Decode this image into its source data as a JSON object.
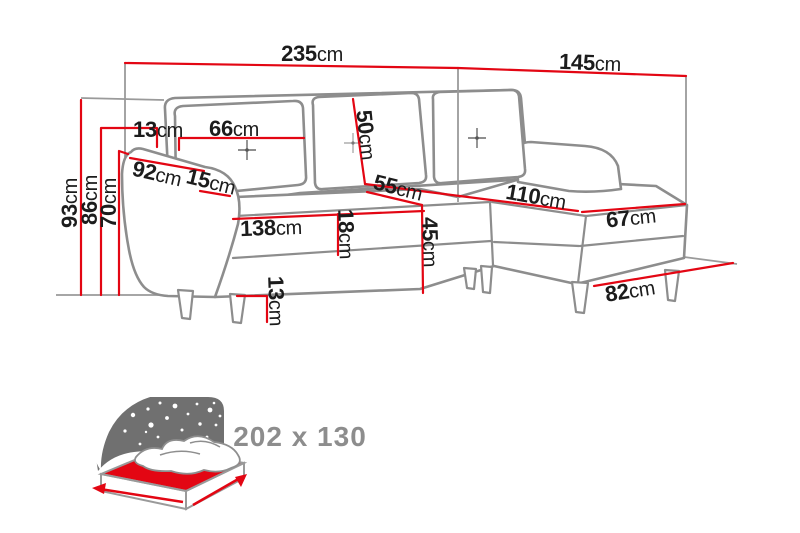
{
  "diagram_type": "corner-sofa-dimension-diagram",
  "unit": "cm",
  "dims": {
    "w235": {
      "num": "235",
      "unit": "cm"
    },
    "w145": {
      "num": "145",
      "unit": "cm"
    },
    "h93": {
      "num": "93",
      "unit": "cm"
    },
    "h86": {
      "num": "86",
      "unit": "cm"
    },
    "h70": {
      "num": "70",
      "unit": "cm"
    },
    "t13": {
      "num": "13",
      "unit": "cm"
    },
    "c66": {
      "num": "66",
      "unit": "cm"
    },
    "b50": {
      "num": "50",
      "unit": "cm"
    },
    "a92": {
      "num": "92",
      "unit": "cm"
    },
    "a15": {
      "num": "15",
      "unit": "cm"
    },
    "s55": {
      "num": "55",
      "unit": "cm"
    },
    "ch110": {
      "num": "110",
      "unit": "cm"
    },
    "s138": {
      "num": "138",
      "unit": "cm"
    },
    "s18": {
      "num": "18",
      "unit": "cm"
    },
    "s45": {
      "num": "45",
      "unit": "cm"
    },
    "ch67": {
      "num": "67",
      "unit": "cm"
    },
    "leg13": {
      "num": "13",
      "unit": "cm"
    },
    "ch82": {
      "num": "82",
      "unit": "cm"
    }
  },
  "bed": {
    "icon": "sofa-bed-icon",
    "size": "202 x 130"
  },
  "colors": {
    "dimension_red": "#e30613",
    "sofa_outline": "#8d8d8d",
    "label_text": "#1c1c1c",
    "bed_text": "#8d8d8d",
    "bed_night": "#707070"
  }
}
